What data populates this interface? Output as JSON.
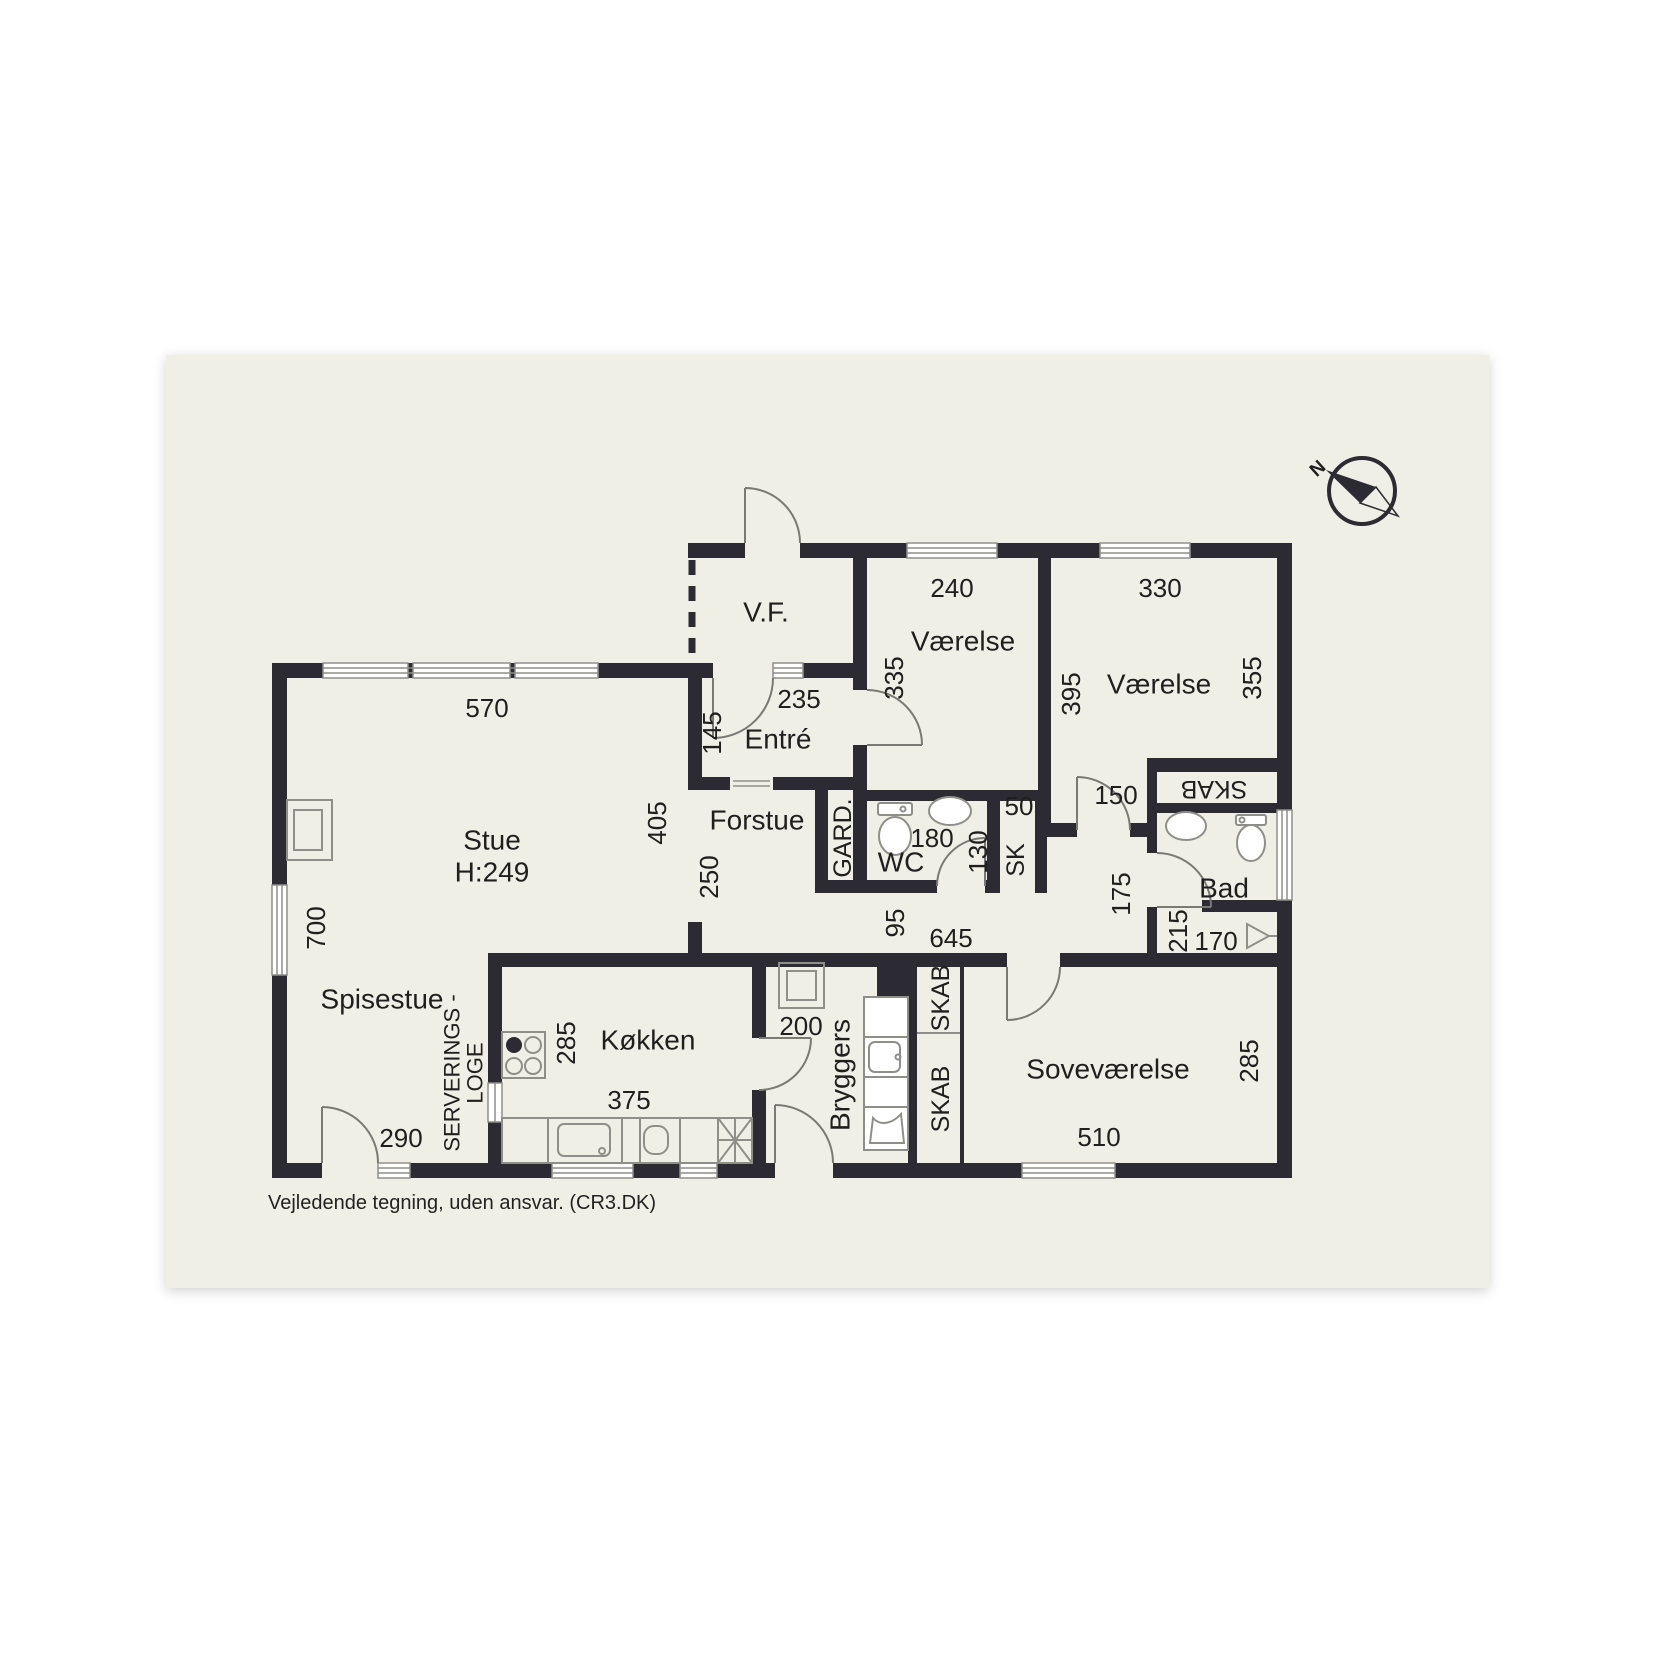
{
  "page": {
    "disclaimer": "Vejledende tegning, uden ansvar. (CR3.DK)",
    "canvas_color": "#f0efe6",
    "wall_color": "#2c2b34",
    "background_color": "#ffffff",
    "ceiling_height_note": "H:249"
  },
  "compass": {
    "label": "N"
  },
  "rooms": [
    "V.F.",
    "Entré",
    "Forstue",
    "Stue",
    "Spisestue",
    "Køkken",
    "Bryggers",
    "Soveværelse",
    "Værelse",
    "Værelse",
    "WC",
    "Bad"
  ],
  "closets": [
    "GARD.",
    "SK",
    "SKAB",
    "SKAB",
    "SKAB",
    "SERVERINGS - LOGE"
  ],
  "labels": [
    {
      "name": "room-label-vf",
      "text": "V.F.",
      "x": 766,
      "y": 612,
      "rot": 0,
      "cls": "lbl-room"
    },
    {
      "name": "room-label-entre",
      "text": "Entré",
      "x": 778,
      "y": 739,
      "rot": 0,
      "cls": "lbl-room"
    },
    {
      "name": "room-label-forstue",
      "text": "Forstue",
      "x": 757,
      "y": 820,
      "rot": 0,
      "cls": "lbl-room"
    },
    {
      "name": "room-label-stue",
      "text": "Stue",
      "x": 492,
      "y": 840,
      "rot": 0,
      "cls": "lbl-room"
    },
    {
      "name": "room-label-stue-height",
      "text": "H:249",
      "x": 492,
      "y": 872,
      "rot": 0,
      "cls": "lbl-room"
    },
    {
      "name": "room-label-spisestue",
      "text": "Spisestue",
      "x": 382,
      "y": 999,
      "rot": 0,
      "cls": "lbl-room"
    },
    {
      "name": "room-label-koekken",
      "text": "Køkken",
      "x": 648,
      "y": 1040,
      "rot": 0,
      "cls": "lbl-room"
    },
    {
      "name": "room-label-bryggers",
      "text": "Bryggers",
      "x": 840,
      "y": 1075,
      "rot": -90,
      "cls": "lbl-room"
    },
    {
      "name": "room-label-sovevaerelse",
      "text": "Soveværelse",
      "x": 1108,
      "y": 1069,
      "rot": 0,
      "cls": "lbl-room"
    },
    {
      "name": "room-label-vaerelse-1",
      "text": "Værelse",
      "x": 963,
      "y": 641,
      "rot": 0,
      "cls": "lbl-room"
    },
    {
      "name": "room-label-vaerelse-2",
      "text": "Værelse",
      "x": 1159,
      "y": 684,
      "rot": 0,
      "cls": "lbl-room"
    },
    {
      "name": "room-label-wc",
      "text": "WC",
      "x": 901,
      "y": 862,
      "rot": 0,
      "cls": "lbl-room"
    },
    {
      "name": "room-label-bad",
      "text": "Bad",
      "x": 1224,
      "y": 888,
      "rot": 0,
      "cls": "lbl-room"
    },
    {
      "name": "closet-label-gard",
      "text": "GARD.",
      "x": 843,
      "y": 838,
      "rot": -90,
      "cls": "lbl-closet"
    },
    {
      "name": "closet-label-sk",
      "text": "SK",
      "x": 1016,
      "y": 860,
      "rot": -90,
      "cls": "lbl-closet"
    },
    {
      "name": "closet-label-skab-bad",
      "text": "SKAB",
      "x": 1214,
      "y": 789,
      "rot": 180,
      "cls": "lbl-closet"
    },
    {
      "name": "closet-label-skab-1",
      "text": "SKAB",
      "x": 941,
      "y": 998,
      "rot": -90,
      "cls": "lbl-closet"
    },
    {
      "name": "closet-label-skab-2",
      "text": "SKAB",
      "x": 941,
      "y": 1099,
      "rot": -90,
      "cls": "lbl-closet"
    },
    {
      "name": "label-serverings",
      "text": "SERVERINGS -",
      "x": 452,
      "y": 1073,
      "rot": -90,
      "cls": "lbl-small"
    },
    {
      "name": "label-loge",
      "text": "LOGE",
      "x": 475,
      "y": 1073,
      "rot": -90,
      "cls": "lbl-small"
    },
    {
      "name": "dim-570",
      "text": "570",
      "x": 487,
      "y": 708,
      "rot": 0,
      "cls": "lbl-dim"
    },
    {
      "name": "dim-700",
      "text": "700",
      "x": 316,
      "y": 928,
      "rot": -90,
      "cls": "lbl-dim"
    },
    {
      "name": "dim-405",
      "text": "405",
      "x": 657,
      "y": 823,
      "rot": -90,
      "cls": "lbl-dim"
    },
    {
      "name": "dim-250",
      "text": "250",
      "x": 709,
      "y": 877,
      "rot": -90,
      "cls": "lbl-dim"
    },
    {
      "name": "dim-145",
      "text": "145",
      "x": 712,
      "y": 733,
      "rot": -90,
      "cls": "lbl-dim"
    },
    {
      "name": "dim-235",
      "text": "235",
      "x": 799,
      "y": 699,
      "rot": 0,
      "cls": "lbl-dim"
    },
    {
      "name": "dim-335",
      "text": "335",
      "x": 894,
      "y": 678,
      "rot": -90,
      "cls": "lbl-dim"
    },
    {
      "name": "dim-240",
      "text": "240",
      "x": 952,
      "y": 588,
      "rot": 0,
      "cls": "lbl-dim"
    },
    {
      "name": "dim-330",
      "text": "330",
      "x": 1160,
      "y": 588,
      "rot": 0,
      "cls": "lbl-dim"
    },
    {
      "name": "dim-395",
      "text": "395",
      "x": 1071,
      "y": 694,
      "rot": -90,
      "cls": "lbl-dim"
    },
    {
      "name": "dim-355",
      "text": "355",
      "x": 1252,
      "y": 678,
      "rot": -90,
      "cls": "lbl-dim"
    },
    {
      "name": "dim-150",
      "text": "150",
      "x": 1116,
      "y": 795,
      "rot": 0,
      "cls": "lbl-dim"
    },
    {
      "name": "dim-50",
      "text": "50",
      "x": 1019,
      "y": 806,
      "rot": 0,
      "cls": "lbl-dim"
    },
    {
      "name": "dim-180",
      "text": "180",
      "x": 932,
      "y": 838,
      "rot": 0,
      "cls": "lbl-dim"
    },
    {
      "name": "dim-130",
      "text": "130",
      "x": 978,
      "y": 852,
      "rot": -90,
      "cls": "lbl-dim"
    },
    {
      "name": "dim-95",
      "text": "95",
      "x": 895,
      "y": 923,
      "rot": -90,
      "cls": "lbl-dim"
    },
    {
      "name": "dim-645",
      "text": "645",
      "x": 951,
      "y": 938,
      "rot": 0,
      "cls": "lbl-dim"
    },
    {
      "name": "dim-175",
      "text": "175",
      "x": 1121,
      "y": 894,
      "rot": -90,
      "cls": "lbl-dim"
    },
    {
      "name": "dim-215",
      "text": "215",
      "x": 1178,
      "y": 931,
      "rot": -90,
      "cls": "lbl-dim"
    },
    {
      "name": "dim-170",
      "text": "170",
      "x": 1216,
      "y": 941,
      "rot": 0,
      "cls": "lbl-dim"
    },
    {
      "name": "dim-200",
      "text": "200",
      "x": 801,
      "y": 1026,
      "rot": 0,
      "cls": "lbl-dim"
    },
    {
      "name": "dim-290",
      "text": "290",
      "x": 401,
      "y": 1138,
      "rot": 0,
      "cls": "lbl-dim"
    },
    {
      "name": "dim-285-koekken",
      "text": "285",
      "x": 566,
      "y": 1043,
      "rot": -90,
      "cls": "lbl-dim"
    },
    {
      "name": "dim-375",
      "text": "375",
      "x": 629,
      "y": 1100,
      "rot": 0,
      "cls": "lbl-dim"
    },
    {
      "name": "dim-285-sovevaerelse",
      "text": "285",
      "x": 1249,
      "y": 1061,
      "rot": -90,
      "cls": "lbl-dim"
    },
    {
      "name": "dim-510",
      "text": "510",
      "x": 1099,
      "y": 1137,
      "rot": 0,
      "cls": "lbl-dim"
    },
    {
      "name": "compass-n-label",
      "text": "N",
      "x": 1318,
      "y": 469,
      "rot": -42,
      "cls": "lbl-compass"
    }
  ]
}
